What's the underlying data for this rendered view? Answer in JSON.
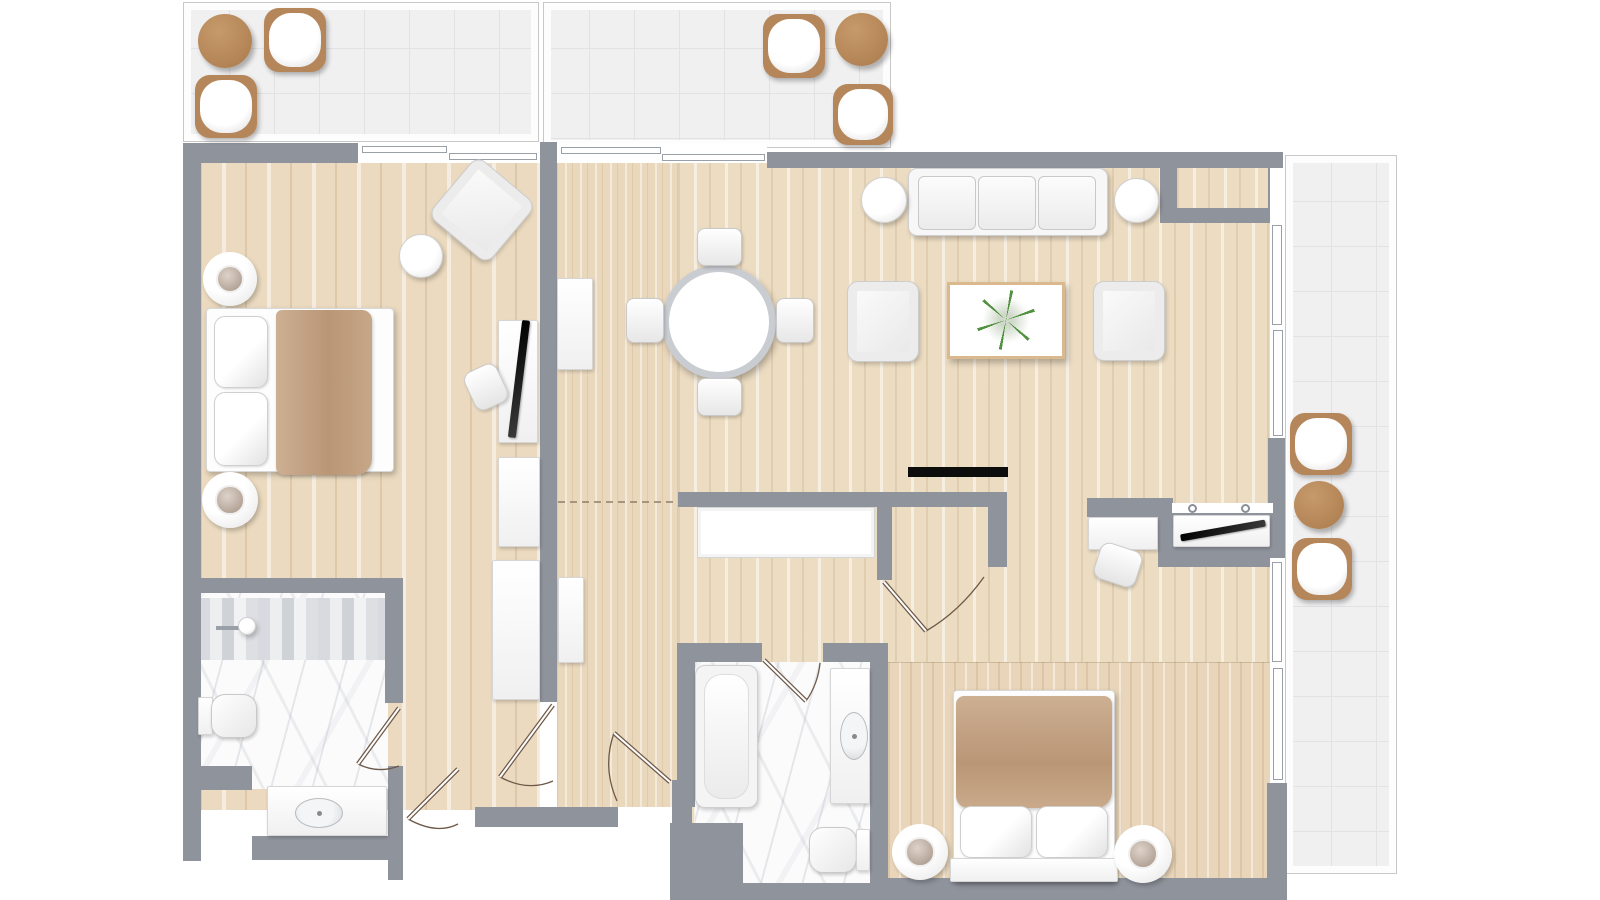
{
  "plan": {
    "canvas": {
      "w": 1600,
      "h": 900,
      "bg": "#ffffff"
    },
    "palette": {
      "wall": "#8f939c",
      "wood": "#ecdcc2",
      "tile": "#f0f0f1",
      "marble": "#fbfbfc",
      "accent_brown": "#b5865a",
      "blanket_brown": "#bf9e80",
      "plant_green": "#488c34",
      "door_line": "#6e5948"
    },
    "floors": [
      {
        "name": "balcony-top-left",
        "type": "tile",
        "x": 183,
        "y": 2,
        "w": 356,
        "h": 140
      },
      {
        "name": "balcony-top-center",
        "type": "tile",
        "x": 543,
        "y": 2,
        "w": 348,
        "h": 146
      },
      {
        "name": "balcony-right",
        "type": "tile",
        "x": 1285,
        "y": 155,
        "w": 112,
        "h": 719
      },
      {
        "name": "bedroom1-floor",
        "type": "wood-coarse",
        "x": 200,
        "y": 160,
        "w": 340,
        "h": 650
      },
      {
        "name": "hall-floor",
        "type": "wood-fine",
        "x": 557,
        "y": 163,
        "w": 121,
        "h": 644
      },
      {
        "name": "living-dining-floor",
        "type": "wood",
        "x": 678,
        "y": 163,
        "w": 592,
        "h": 715
      },
      {
        "name": "bedroom2-floor",
        "type": "wood-fine2",
        "x": 888,
        "y": 662,
        "w": 382,
        "h": 216
      },
      {
        "name": "bathroom1-marble",
        "type": "marble",
        "x": 198,
        "y": 593,
        "w": 190,
        "h": 196
      },
      {
        "name": "bathroom1-mosaic-strip",
        "type": "mosaic",
        "x": 198,
        "y": 598,
        "w": 189,
        "h": 62
      },
      {
        "name": "bathroom2-marble",
        "type": "marble",
        "x": 695,
        "y": 662,
        "w": 175,
        "h": 221
      },
      {
        "name": "hall-closet-interior",
        "type": "floor-white",
        "x": 697,
        "y": 507,
        "w": 178,
        "h": 51
      },
      {
        "name": "alcove-inset-floor",
        "type": "wood",
        "x": 1177,
        "y": 168,
        "w": 91,
        "h": 40,
        "layer": "top"
      }
    ],
    "walls": [
      {
        "name": "left-outer-wall",
        "x": 183,
        "y": 143,
        "w": 18,
        "h": 718
      },
      {
        "name": "bedroom1-top-wall",
        "x": 183,
        "y": 143,
        "w": 175,
        "h": 20
      },
      {
        "name": "bedroom1-east-wall",
        "x": 540,
        "y": 142,
        "w": 17,
        "h": 560
      },
      {
        "name": "hall-bottom-wall",
        "x": 475,
        "y": 807,
        "w": 143,
        "h": 20
      },
      {
        "name": "bathroom1-top-wall",
        "x": 183,
        "y": 578,
        "w": 220,
        "h": 15
      },
      {
        "name": "bathroom1-right-wall-upper",
        "x": 385,
        "y": 593,
        "w": 18,
        "h": 110
      },
      {
        "name": "bathroom1-right-wall-lower",
        "x": 388,
        "y": 766,
        "w": 15,
        "h": 114
      },
      {
        "name": "bathroom1-left-step-wall",
        "x": 200,
        "y": 766,
        "w": 52,
        "h": 24
      },
      {
        "name": "vanity1-bottom-wall",
        "x": 252,
        "y": 836,
        "w": 151,
        "h": 24
      },
      {
        "name": "living-top-wall",
        "x": 767,
        "y": 152,
        "w": 516,
        "h": 16
      },
      {
        "name": "topright-alcove-wall",
        "x": 1160,
        "y": 152,
        "w": 123,
        "h": 71
      },
      {
        "name": "right-wall-mid-block",
        "x": 1268,
        "y": 438,
        "w": 17,
        "h": 120
      },
      {
        "name": "right-wall-bottom-corner",
        "x": 1267,
        "y": 783,
        "w": 20,
        "h": 100
      },
      {
        "name": "bottom-main-wall",
        "x": 873,
        "y": 878,
        "w": 414,
        "h": 22
      },
      {
        "name": "bedroom2-left-wall",
        "x": 870,
        "y": 652,
        "w": 18,
        "h": 245
      },
      {
        "name": "bathroom2-left-wall",
        "x": 677,
        "y": 643,
        "w": 18,
        "h": 164
      },
      {
        "name": "bathroom2-top-wall-left",
        "x": 677,
        "y": 643,
        "w": 85,
        "h": 19
      },
      {
        "name": "bathroom2-top-wall-right",
        "x": 823,
        "y": 643,
        "w": 65,
        "h": 19
      },
      {
        "name": "bathroom2-bottomleft-block",
        "x": 670,
        "y": 823,
        "w": 73,
        "h": 77
      },
      {
        "name": "bathroom2-bottom-wall",
        "x": 743,
        "y": 883,
        "w": 130,
        "h": 17
      },
      {
        "name": "entry-right-jamb-wall",
        "x": 672,
        "y": 780,
        "w": 20,
        "h": 45
      },
      {
        "name": "hall-closet-wall",
        "x": 678,
        "y": 492,
        "w": 329,
        "h": 15
      },
      {
        "name": "closet-door-stub-wall",
        "x": 877,
        "y": 507,
        "w": 15,
        "h": 73
      },
      {
        "name": "closet-right-wall",
        "x": 988,
        "y": 507,
        "w": 19,
        "h": 60
      },
      {
        "name": "desk-wall",
        "x": 1087,
        "y": 498,
        "w": 86,
        "h": 19
      },
      {
        "name": "tv-niche-wall",
        "x": 1158,
        "y": 510,
        "w": 115,
        "h": 57
      }
    ],
    "windows": [
      {
        "name": "bedroom1-sliding-door",
        "x": 358,
        "y": 143,
        "w": 182,
        "h": 20
      },
      {
        "name": "living-sliding-door",
        "x": 557,
        "y": 143,
        "w": 210,
        "h": 20
      },
      {
        "name": "right-window-strip-upper",
        "x": 1270,
        "y": 168,
        "w": 15,
        "h": 270
      },
      {
        "name": "right-window-strip-lower",
        "x": 1270,
        "y": 558,
        "w": 15,
        "h": 225
      },
      {
        "name": "tv-niche-top-strip",
        "x": 1172,
        "y": 503,
        "w": 101,
        "h": 10
      }
    ],
    "window_panels": [
      {
        "name": "sliding-panel",
        "x": 362,
        "y": 146,
        "w": 85,
        "h": 7
      },
      {
        "name": "sliding-panel",
        "x": 449,
        "y": 153,
        "w": 88,
        "h": 7
      },
      {
        "name": "sliding-panel",
        "x": 561,
        "y": 147,
        "w": 100,
        "h": 7
      },
      {
        "name": "sliding-panel",
        "x": 662,
        "y": 154,
        "w": 103,
        "h": 7
      },
      {
        "name": "window-panel",
        "x": 1272,
        "y": 225,
        "w": 10,
        "h": 100
      },
      {
        "name": "window-panel",
        "x": 1273,
        "y": 330,
        "w": 10,
        "h": 106
      },
      {
        "name": "window-panel",
        "x": 1272,
        "y": 562,
        "w": 10,
        "h": 100
      },
      {
        "name": "window-panel",
        "x": 1273,
        "y": 668,
        "w": 10,
        "h": 112
      }
    ],
    "furniture": [
      {
        "name": "balcony1-round-table",
        "type": "roundbrown",
        "x": 198,
        "y": 14,
        "w": 54,
        "h": 54
      },
      {
        "name": "balcony1-chair-a",
        "type": "outdoorchair",
        "x": 264,
        "y": 8,
        "w": 62,
        "h": 64
      },
      {
        "name": "balcony1-chair-b",
        "type": "outdoorchair",
        "x": 195,
        "y": 75,
        "w": 62,
        "h": 63
      },
      {
        "name": "balcony2-chair-a",
        "type": "outdoorchair",
        "x": 763,
        "y": 14,
        "w": 62,
        "h": 64
      },
      {
        "name": "balcony2-round-table",
        "type": "roundbrown",
        "x": 835,
        "y": 13,
        "w": 53,
        "h": 53
      },
      {
        "name": "balcony2-chair-b",
        "type": "outdoorchair",
        "x": 833,
        "y": 84,
        "w": 60,
        "h": 61
      },
      {
        "name": "balcony3-chair-a",
        "type": "outdoorchair",
        "x": 1290,
        "y": 413,
        "w": 62,
        "h": 62
      },
      {
        "name": "balcony3-round-table",
        "type": "roundbrown",
        "x": 1294,
        "y": 481,
        "w": 50,
        "h": 48
      },
      {
        "name": "balcony3-chair-b",
        "type": "outdoorchair",
        "x": 1292,
        "y": 538,
        "w": 60,
        "h": 62
      },
      {
        "name": "bedroom1-armchair",
        "type": "framechair",
        "x": 444,
        "y": 172,
        "w": 76,
        "h": 76,
        "r": 40
      },
      {
        "name": "bedroom1-side-table",
        "type": "roundwhite",
        "x": 399,
        "y": 234,
        "w": 44,
        "h": 44
      },
      {
        "name": "bedroom1-nightstand-top",
        "type": "nightstand",
        "x": 203,
        "y": 252,
        "w": 54,
        "h": 54
      },
      {
        "name": "bedroom1-bed",
        "type": "bedbase",
        "x": 206,
        "y": 308,
        "w": 188,
        "h": 164
      },
      {
        "name": "bedroom1-pillow-a",
        "type": "pillow",
        "x": 214,
        "y": 316,
        "w": 54,
        "h": 72
      },
      {
        "name": "bedroom1-pillow-b",
        "type": "pillow",
        "x": 214,
        "y": 392,
        "w": 54,
        "h": 74
      },
      {
        "name": "bedroom1-blanket",
        "type": "blanketv",
        "x": 276,
        "y": 310,
        "w": 96,
        "h": 165
      },
      {
        "name": "bedroom1-nightstand-bottom",
        "type": "nightstand",
        "x": 202,
        "y": 472,
        "w": 56,
        "h": 56
      },
      {
        "name": "bedroom1-tv-console",
        "type": "rectwhite",
        "x": 498,
        "y": 320,
        "w": 40,
        "h": 123
      },
      {
        "name": "bedroom1-tv",
        "type": "tvthin",
        "x": 515,
        "y": 320,
        "w": 8,
        "h": 118,
        "r": 7
      },
      {
        "name": "bedroom1-desk-chair",
        "type": "deskchair",
        "x": 468,
        "y": 366,
        "w": 36,
        "h": 42,
        "r": -25
      },
      {
        "name": "bedroom1-dresser",
        "type": "rectwhite",
        "x": 498,
        "y": 457,
        "w": 42,
        "h": 90
      },
      {
        "name": "bedroom1-wardrobe",
        "type": "rectwhite",
        "x": 492,
        "y": 560,
        "w": 48,
        "h": 140
      },
      {
        "name": "bathroom1-shower-arm",
        "type": "bar",
        "x": 216,
        "y": 626,
        "w": 26,
        "h": 4
      },
      {
        "name": "bathroom1-shower-head",
        "type": "roundwhite",
        "x": 238,
        "y": 617,
        "w": 18,
        "h": 18
      },
      {
        "name": "bathroom1-toilet-tank",
        "type": "rectwhite",
        "x": 198,
        "y": 697,
        "w": 15,
        "h": 38
      },
      {
        "name": "bathroom1-toilet-bowl",
        "type": "toiletbowl",
        "x": 211,
        "y": 694,
        "w": 46,
        "h": 44
      },
      {
        "name": "bathroom1-vanity-counter",
        "type": "rectwhite",
        "x": 267,
        "y": 786,
        "w": 120,
        "h": 50
      },
      {
        "name": "bathroom1-sink",
        "type": "sink",
        "x": 295,
        "y": 798,
        "w": 48,
        "h": 30
      },
      {
        "name": "hall-sideboard-upper",
        "type": "rectwhite",
        "x": 557,
        "y": 278,
        "w": 36,
        "h": 92
      },
      {
        "name": "hall-console-lower",
        "type": "rectwhite",
        "x": 558,
        "y": 577,
        "w": 26,
        "h": 86
      },
      {
        "name": "dining-table",
        "type": "ringtable",
        "x": 662,
        "y": 265,
        "w": 114,
        "h": 114
      },
      {
        "name": "dining-chair-top",
        "type": "dchair",
        "x": 697,
        "y": 228,
        "w": 45,
        "h": 38
      },
      {
        "name": "dining-chair-bottom",
        "type": "dchair",
        "x": 697,
        "y": 378,
        "w": 45,
        "h": 38
      },
      {
        "name": "dining-chair-left",
        "type": "dchair",
        "x": 626,
        "y": 298,
        "w": 38,
        "h": 45
      },
      {
        "name": "dining-chair-right",
        "type": "dchair",
        "x": 776,
        "y": 298,
        "w": 38,
        "h": 45
      },
      {
        "name": "sofa",
        "type": "sofabase",
        "x": 908,
        "y": 168,
        "w": 200,
        "h": 68
      },
      {
        "name": "sofa-cushion-left",
        "type": "cushion",
        "x": 918,
        "y": 176,
        "w": 58,
        "h": 54
      },
      {
        "name": "sofa-cushion-middle",
        "type": "cushion",
        "x": 978,
        "y": 176,
        "w": 58,
        "h": 54
      },
      {
        "name": "sofa-cushion-right",
        "type": "cushion",
        "x": 1038,
        "y": 176,
        "w": 58,
        "h": 54
      },
      {
        "name": "sofa-side-table-left",
        "type": "roundwhite",
        "x": 861,
        "y": 177,
        "w": 46,
        "h": 46
      },
      {
        "name": "sofa-side-table-right",
        "type": "roundwhite",
        "x": 1114,
        "y": 178,
        "w": 45,
        "h": 45
      },
      {
        "name": "living-armchair-left",
        "type": "framechair",
        "x": 848,
        "y": 282,
        "w": 70,
        "h": 79
      },
      {
        "name": "living-armchair-right",
        "type": "framechair",
        "x": 1094,
        "y": 282,
        "w": 70,
        "h": 78
      },
      {
        "name": "coffee-table",
        "type": "coffeetable",
        "x": 947,
        "y": 282,
        "w": 118,
        "h": 77
      },
      {
        "name": "coffee-table-plant",
        "type": "plant",
        "x": 976,
        "y": 290,
        "w": 60,
        "h": 60
      },
      {
        "name": "living-wall-tv",
        "type": "tvbar",
        "x": 908,
        "y": 467,
        "w": 100,
        "h": 10
      },
      {
        "name": "desk",
        "type": "rectwhite",
        "x": 1088,
        "y": 517,
        "w": 70,
        "h": 33
      },
      {
        "name": "desk-chair",
        "type": "deskchair",
        "x": 1096,
        "y": 546,
        "w": 44,
        "h": 38,
        "r": 18
      },
      {
        "name": "tv-niche-shelf",
        "type": "rectwhite",
        "x": 1173,
        "y": 515,
        "w": 97,
        "h": 32
      },
      {
        "name": "niche-tv",
        "type": "tvthin",
        "x": 1180,
        "y": 527,
        "w": 86,
        "h": 7,
        "r": -10
      },
      {
        "name": "niche-knob-left",
        "type": "knob",
        "x": 1188,
        "y": 504,
        "w": 9,
        "h": 9
      },
      {
        "name": "niche-knob-right",
        "type": "knob",
        "x": 1241,
        "y": 504,
        "w": 9,
        "h": 9
      },
      {
        "name": "bathroom2-bathtub",
        "type": "tub",
        "x": 695,
        "y": 665,
        "w": 63,
        "h": 143
      },
      {
        "name": "bathroom2-vanity",
        "type": "rectwhite",
        "x": 830,
        "y": 668,
        "w": 40,
        "h": 136
      },
      {
        "name": "bathroom2-sink",
        "type": "sink",
        "x": 840,
        "y": 712,
        "w": 28,
        "h": 48
      },
      {
        "name": "bathroom2-toilet-bowl",
        "type": "toiletbowl",
        "x": 809,
        "y": 827,
        "w": 48,
        "h": 46
      },
      {
        "name": "bathroom2-toilet-tank",
        "type": "rectwhite",
        "x": 856,
        "y": 829,
        "w": 14,
        "h": 42
      },
      {
        "name": "bedroom2-nightstand-left",
        "type": "nightstand",
        "x": 892,
        "y": 824,
        "w": 56,
        "h": 56
      },
      {
        "name": "bedroom2-bed",
        "type": "bedbase",
        "x": 953,
        "y": 690,
        "w": 162,
        "h": 192
      },
      {
        "name": "bedroom2-blanket",
        "type": "blanketh",
        "x": 956,
        "y": 696,
        "w": 156,
        "h": 112
      },
      {
        "name": "bedroom2-pillow-left",
        "type": "pillow",
        "x": 960,
        "y": 806,
        "w": 72,
        "h": 52
      },
      {
        "name": "bedroom2-pillow-right",
        "type": "pillow",
        "x": 1036,
        "y": 806,
        "w": 72,
        "h": 52
      },
      {
        "name": "bedroom2-headboard",
        "type": "rectwhite",
        "x": 950,
        "y": 858,
        "w": 168,
        "h": 24
      },
      {
        "name": "bedroom2-nightstand-right",
        "type": "nightstand",
        "x": 1114,
        "y": 825,
        "w": 58,
        "h": 58
      }
    ],
    "doors": [
      {
        "name": "bathroom1-door",
        "leaf": [
          399,
          708,
          358,
          764
        ],
        "arc": "M358,764 Q378,774 399,766"
      },
      {
        "name": "connecting-door",
        "leaf": [
          553,
          705,
          500,
          777
        ],
        "arc": "M500,777 Q528,792 553,781"
      },
      {
        "name": "left-unit-entry-door",
        "leaf": [
          458,
          769,
          408,
          819
        ],
        "arc": "M408,819 Q437,835 458,824"
      },
      {
        "name": "main-entry-door",
        "leaf": [
          670,
          782,
          614,
          733
        ],
        "arc": "M614,733 Q602,767 617,801"
      },
      {
        "name": "hall-to-living-door",
        "leaf": [
          884,
          582,
          926,
          631
        ],
        "arc": "M926,631 Q959,612 984,577"
      },
      {
        "name": "bathroom2-door",
        "leaf": [
          764,
          660,
          806,
          701
        ],
        "arc": "M806,701 Q818,684 820,663"
      }
    ],
    "dashed_lines": [
      {
        "name": "room-divider-dashed",
        "x1": 558,
        "y1": 502,
        "x2": 678,
        "y2": 502
      }
    ]
  }
}
